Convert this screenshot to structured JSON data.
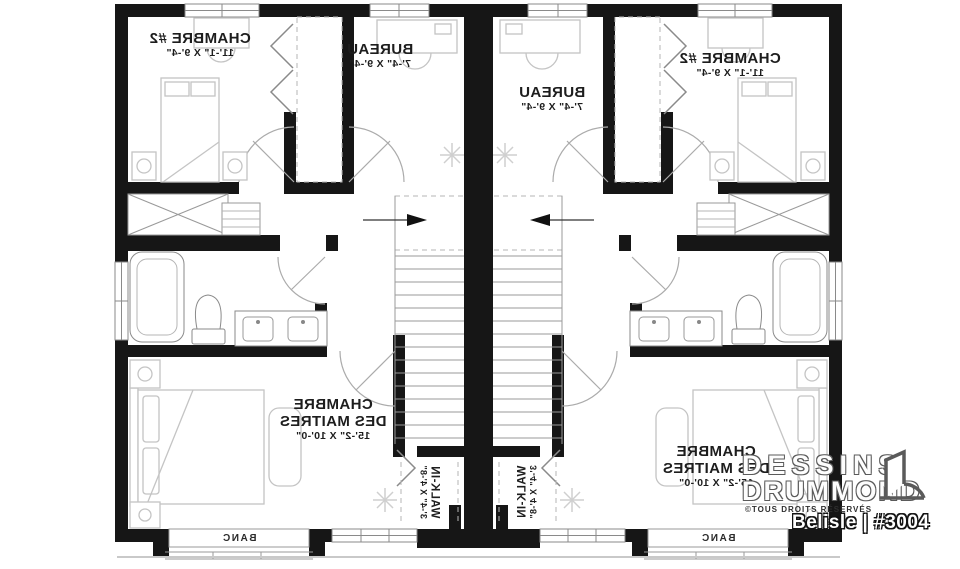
{
  "rooms": {
    "bedroom2": {
      "name": "CHAMBRE #2",
      "dims": "11'-1\" X 9'-4\""
    },
    "office": {
      "name": "BUREAU",
      "dims": "7'-4\" X 9'-4\""
    },
    "master": {
      "name_line1": "CHAMBRE",
      "name_line2": "DES MAITRES",
      "dims": "15'-2\" X 10'-0\""
    },
    "walkin": {
      "name": "WALK-IN",
      "dims": "3'-4\" X 4'-8\""
    },
    "bench": {
      "name": "BANC"
    }
  },
  "watermark": {
    "brand_line1": "DESSINS",
    "brand_line2": "DRUMMOND",
    "rights": "©TOUS DROITS RÉSERVÉS",
    "plan_id": "Belisle | #3004"
  },
  "colors": {
    "wall": "#161616",
    "fixture": "#8a8a8a",
    "furniture": "#c4c4c4",
    "label": "#1d1d1d"
  }
}
